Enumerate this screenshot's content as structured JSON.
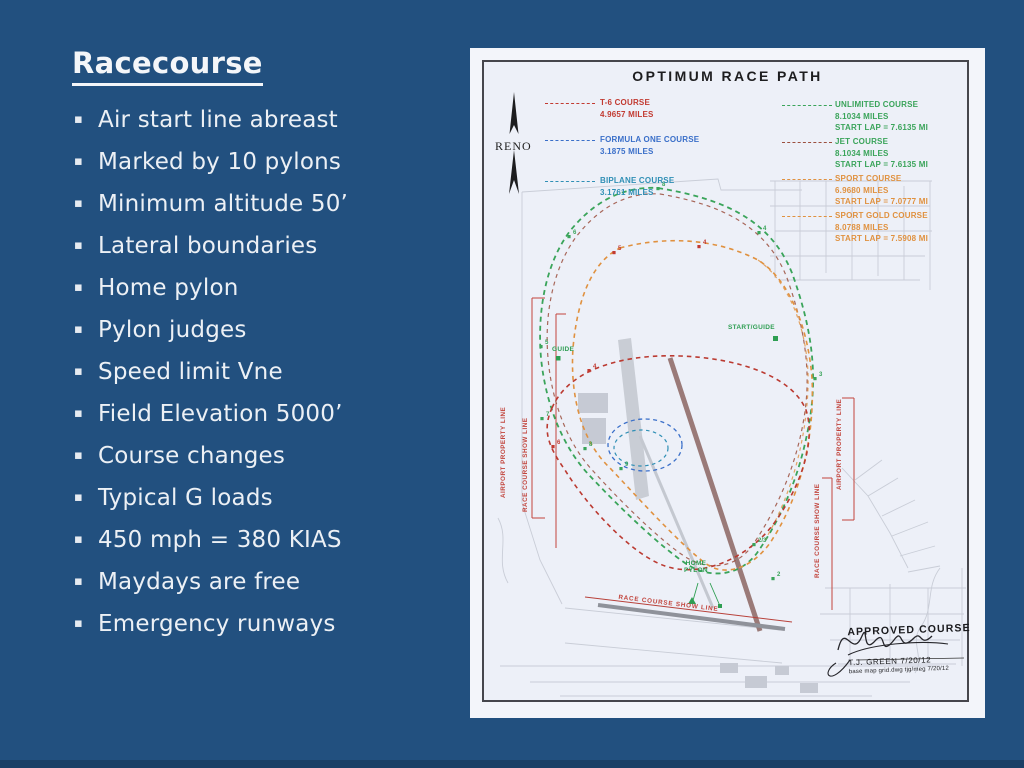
{
  "slide": {
    "title": "Racecourse",
    "bullet_glyph": "▪",
    "bullets_1": [
      "Air start line abreast",
      "Marked by 10 pylons",
      "Minimum altitude 50’",
      "Lateral boundaries",
      "Home pylon",
      "Pylon judges",
      "Speed limit Vne"
    ],
    "bullets_2": [
      "Field Elevation 5000’",
      "Course changes",
      "Typical G loads",
      "450 mph = 380 KIAS"
    ],
    "bullets_3": [
      "Maydays are free",
      "Emergency runways"
    ]
  },
  "map": {
    "title": "OPTIMUM RACE PATH",
    "compass_label": "RENO",
    "legend_left": [
      {
        "line1": "T-6 COURSE",
        "line2": "4.9657 MILES",
        "color": "#c23a31"
      },
      {
        "line1": "FORMULA ONE COURSE",
        "line2": "3.1875 MILES",
        "color": "#3a6fc9"
      },
      {
        "line1": "BIPLANE COURSE",
        "line2": "3.1761 MILES",
        "color": "#2f8fb5"
      }
    ],
    "legend_right": [
      {
        "line1": "UNLIMITED COURSE",
        "line2": "8.1034 MILES",
        "line3": "START LAP = 7.6135 MI",
        "color": "#3aa45a"
      },
      {
        "line1": "JET COURSE",
        "line2": "8.1034 MILES",
        "line3": "START LAP = 7.6135 MI",
        "color": "#3aa45a"
      },
      {
        "line1": "SPORT COURSE",
        "line2": "6.9680 MILES",
        "line3": "START LAP = 7.0777 MI",
        "color": "#e0913f"
      },
      {
        "line1": "SPORT GOLD COURSE",
        "line2": "8.0788 MILES",
        "line3": "START LAP = 7.5908 MI",
        "color": "#e0913f"
      }
    ],
    "labels": {
      "guide": "GUIDE",
      "start_guide": "START/GUIDE",
      "home_pylon_line1": "HOME",
      "home_pylon_line2": "PYLON",
      "airport_property_line": "AIRPORT PROPERTY LINE",
      "race_course_show_line": "RACE COURSE SHOW LINE"
    },
    "approval": {
      "title": "APPROVED COURSE",
      "signer": "T.J. GREEN  7/20/12",
      "note": "base map grid.dwg  tjg/meg  7/20/12"
    },
    "pylons": [
      {
        "x": 188,
        "y": 134,
        "label": "8",
        "color": "#3aa45a"
      },
      {
        "x": 99,
        "y": 182,
        "label": "6",
        "color": "#3aa45a"
      },
      {
        "x": 289,
        "y": 178,
        "label": "4",
        "color": "#3aa45a"
      },
      {
        "x": 71,
        "y": 292,
        "label": "5",
        "color": "#3aa45a"
      },
      {
        "x": 345,
        "y": 324,
        "label": "3",
        "color": "#3aa45a"
      },
      {
        "x": 284,
        "y": 490,
        "label": "2/3",
        "color": "#3aa45a"
      },
      {
        "x": 303,
        "y": 524,
        "label": "2",
        "color": "#3aa45a"
      },
      {
        "x": 151,
        "y": 414,
        "label": "9",
        "color": "#3aa45a"
      },
      {
        "x": 115,
        "y": 394,
        "label": "8",
        "color": "#3aa45a"
      },
      {
        "x": 72,
        "y": 364,
        "label": "7",
        "color": "#3aa45a"
      },
      {
        "x": 144,
        "y": 198,
        "label": "5",
        "color": "#c23a31"
      },
      {
        "x": 229,
        "y": 192,
        "label": "4",
        "color": "#c23a31"
      },
      {
        "x": 119,
        "y": 316,
        "label": "4",
        "color": "#c23a31"
      },
      {
        "x": 83,
        "y": 392,
        "label": "6",
        "color": "#c23a31"
      }
    ],
    "course_colors": {
      "unlimited": "#3aa45a",
      "jet": "#9b4f3e",
      "sport": "#e0913f",
      "t6": "#bb3a31",
      "formula_one": "#3a6fc9",
      "biplane": "#2f8fb5"
    }
  },
  "colors": {
    "background": "#22507f",
    "bottom_strip": "#1a3f66",
    "text": "#ecf0f5",
    "map_paper": "#edf0f8",
    "map_frame": "#46464c",
    "property_line_red": "#c2453d",
    "street_gray": "#c9cdd7",
    "runway_maroon": "#9a7a78"
  }
}
